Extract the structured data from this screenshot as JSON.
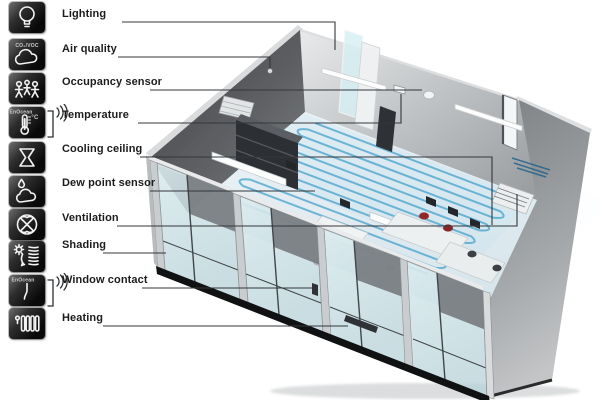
{
  "sidebar": {
    "items": [
      {
        "id": "lighting",
        "label": "Lighting",
        "icon": "bulb-icon"
      },
      {
        "id": "air-quality",
        "label": "Air quality",
        "icon": "cloud-icon",
        "tile_caption": "CO₂/VOC"
      },
      {
        "id": "occupancy-sensor",
        "label": "Occupancy sensor",
        "icon": "people-icon"
      },
      {
        "id": "temperature",
        "label": "Temperature",
        "icon": "thermometer-icon",
        "tile_caption": "EnOcean",
        "unit_label": "°C",
        "wireless": true
      },
      {
        "id": "cooling-ceiling",
        "label": "Cooling ceiling",
        "icon": "hourglass-icon"
      },
      {
        "id": "dew-point-sensor",
        "label": "Dew point sensor",
        "icon": "dew-drop-cloud-icon"
      },
      {
        "id": "ventilation",
        "label": "Ventilation",
        "icon": "fan-icon"
      },
      {
        "id": "shading",
        "label": "Shading",
        "icon": "sun-blinds-icon"
      },
      {
        "id": "window-contact",
        "label": "Window contact",
        "icon": "window-handle-icon",
        "tile_caption": "EnOcean",
        "wireless": true
      },
      {
        "id": "heating",
        "label": "Heating",
        "icon": "radiator-icon"
      }
    ]
  },
  "scene": {
    "type": "isometric-office-cutaway",
    "elements": [
      "cooling-coil-floor",
      "glass-facade-windows",
      "occupancy-dome-sensor",
      "air-quality-wall-sensor",
      "wall-thermostat",
      "ceiling-light-bars",
      "wall-vent-grille",
      "floor-vent-grille",
      "door-opening",
      "office-desks",
      "red-chairs",
      "shelving"
    ]
  },
  "colors": {
    "coil_blue": "#2e96c4",
    "coil_glow": "#9fd2e6",
    "wall_dark": "#545558",
    "wall_light": "#c7cacc",
    "glass": "#d7e9ec",
    "tile_bg": "#111111",
    "label_text": "#1c1c1c",
    "callout_line": "#33373b",
    "chair_red": "#93282c"
  }
}
